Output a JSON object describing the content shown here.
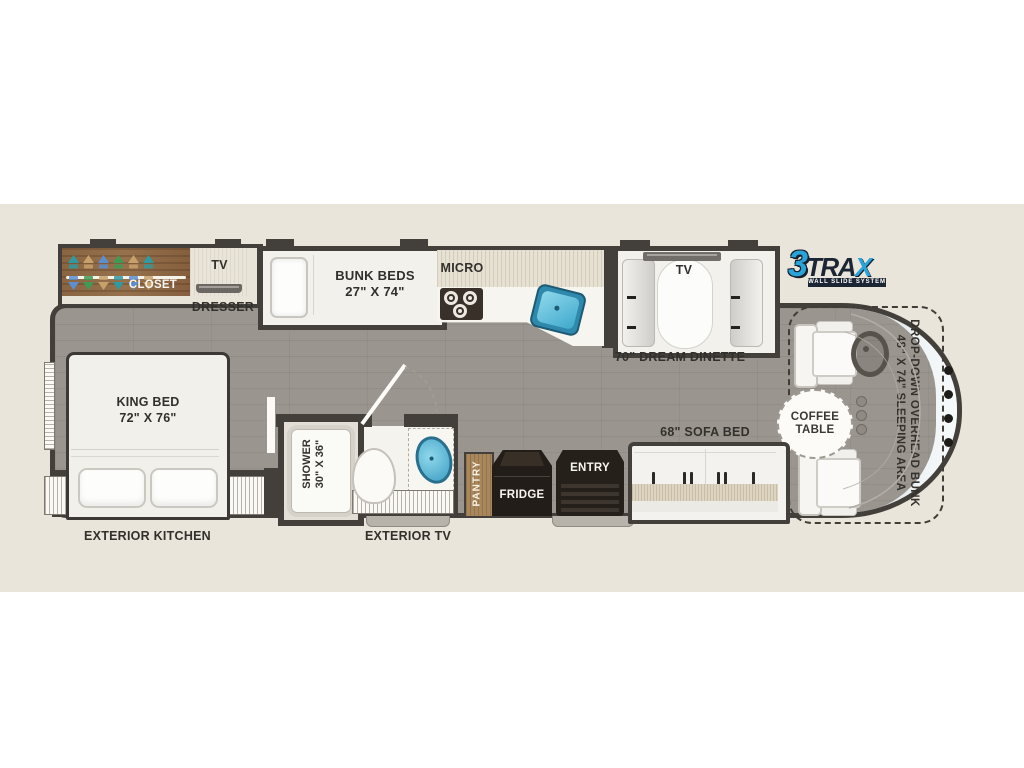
{
  "meta": {
    "title": "RV floor plan - 3TRAX wall slide system",
    "type": "floorplan-diagram"
  },
  "brand": {
    "three": "3",
    "tra": "TRA",
    "x": "X",
    "tagline": "WALL SLIDE SYSTEM",
    "blue": "#2aa3d8",
    "navy": "#1b2533"
  },
  "labels": {
    "closet": "CLOSET",
    "tv_front": "TV",
    "dresser": "DRESSER",
    "bunk_beds": "BUNK BEDS",
    "bunk_dims": "27\" X 74\"",
    "micro": "MICRO",
    "dinette_tv": "TV",
    "dinette": "70\" DREAM DINETTE",
    "king_bed": "KING BED",
    "king_dims": "72\" X 76\"",
    "shower": "SHOWER",
    "shower_dims": "30\" X 36\"",
    "pantry": "PANTRY",
    "fridge": "FRIDGE",
    "entry": "ENTRY",
    "sofa": "68\" SOFA BED",
    "coffee_line1": "COFFEE",
    "coffee_line2": "TABLE",
    "overhead_line1": "DROP-DOWN OVERHEAD BUNK",
    "overhead_line2": "48\" X 74\" SLEEPING AREA",
    "exterior_kitchen": "EXTERIOR KITCHEN",
    "exterior_tv": "EXTERIOR TV"
  },
  "colors": {
    "band": "#e9e5db",
    "wall": "#43403b",
    "floor": "#9a968f",
    "sink_blue": "#3d9dc2",
    "closet_wood": "#8d6946",
    "pantry_wood": "#a8875c",
    "appliance_dark": "#241f19",
    "slide_interior": "#f3f1ec"
  },
  "icons": {
    "hanger": "triangle-hanger",
    "steering_wheel": "ring",
    "burner": "double-circle",
    "sink": "rounded-basin",
    "toilet": "egg-shape",
    "seatbelt": "dark-bar",
    "windshield_vent": "black-dot",
    "cupholder": "gray-dot"
  }
}
